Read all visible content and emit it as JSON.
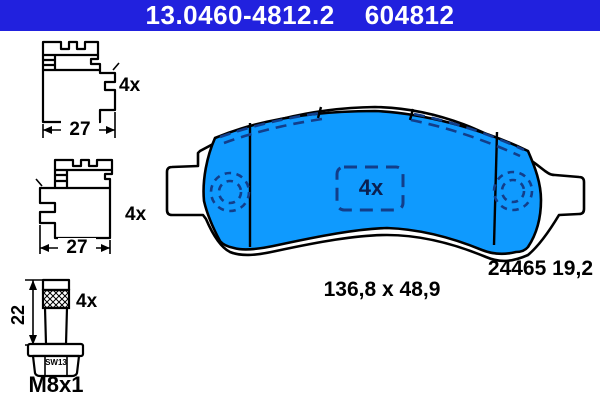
{
  "title_bar": {
    "part_number": "13.0460-4812.2",
    "article_number": "604812"
  },
  "colors": {
    "header_bg": "#2121de",
    "header_text": "#ffffff",
    "pad_fill": "#0f9afe",
    "dash_navy": "#123e8a",
    "pad_qty_text": "#0a2050",
    "line": "#000000"
  },
  "accessories": {
    "clip_top": {
      "qty": "4x",
      "width_mm": "27"
    },
    "clip_bottom": {
      "qty": "4x",
      "width_mm": "27"
    },
    "bolt": {
      "qty": "4x",
      "length_mm": "22",
      "wrench_size": "SW13",
      "thread": "M8x1"
    }
  },
  "pad": {
    "qty": "4x",
    "wva_label": "24465 19,2",
    "dimensions_label": "136,8 x 48,9"
  }
}
